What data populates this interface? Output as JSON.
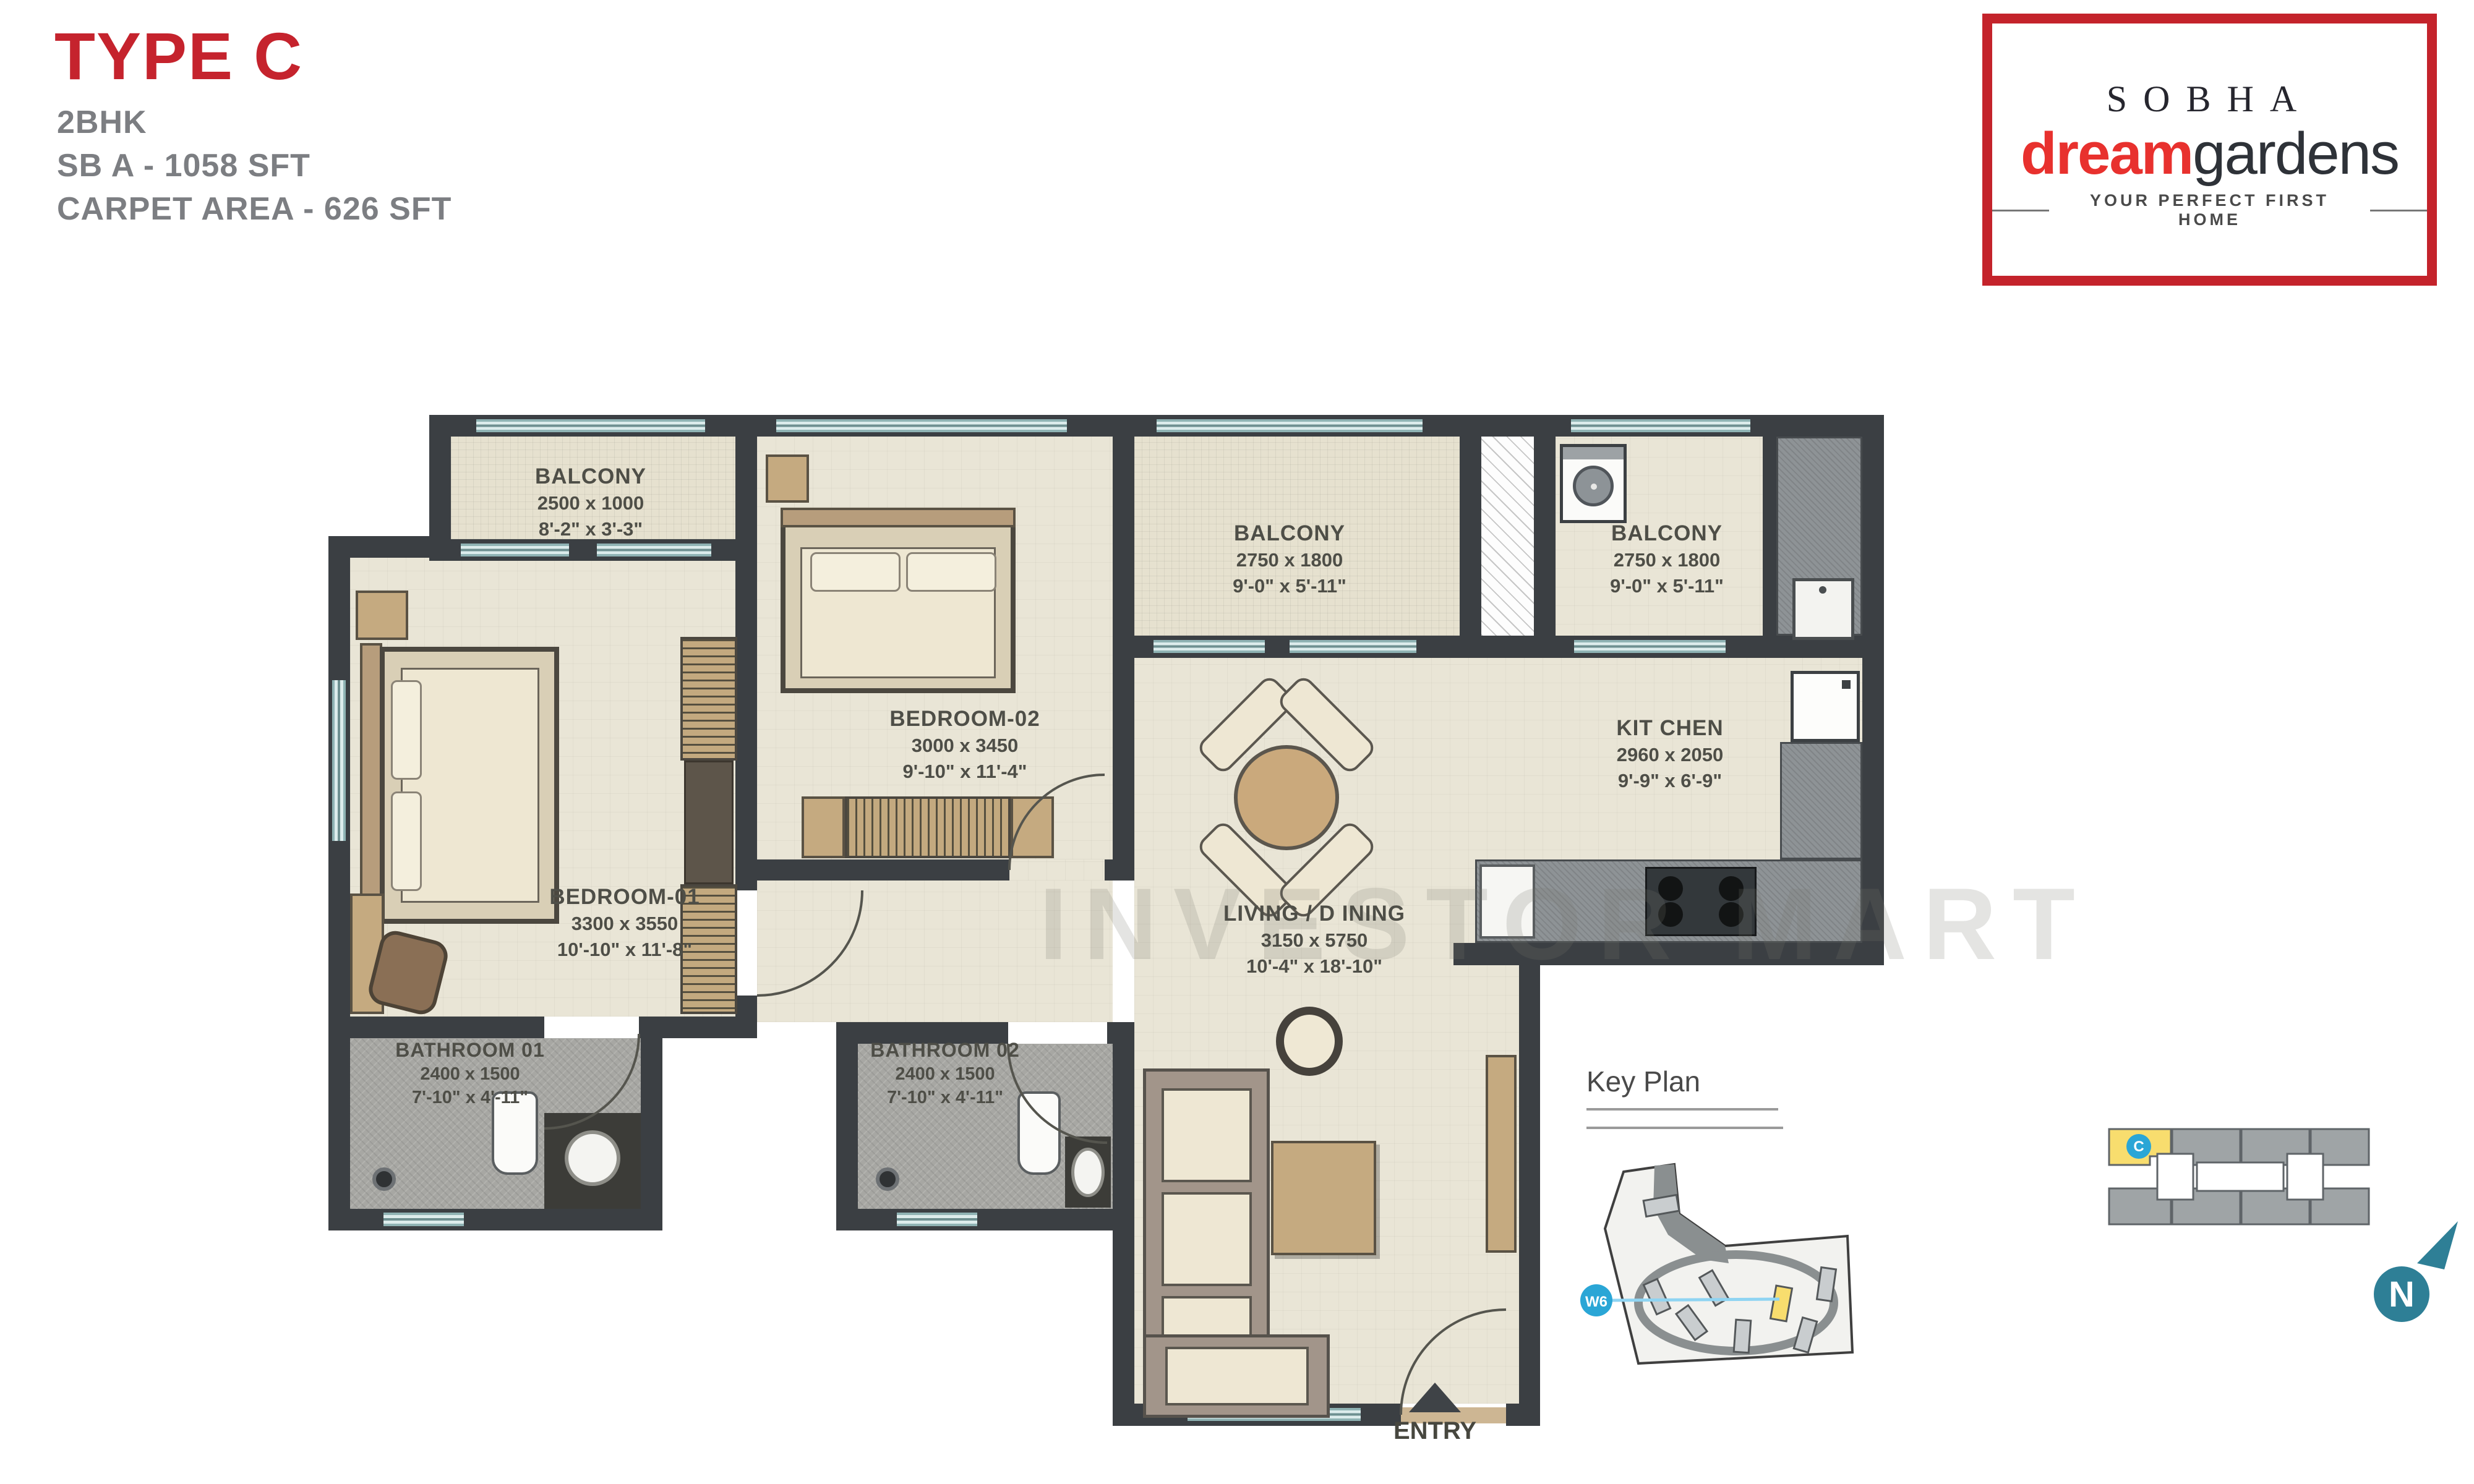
{
  "title_block": {
    "type": "TYPE C",
    "config": "2BHK",
    "sba": "SB A - 1058 SFT",
    "carpet": "CARPET  AREA - 626 SFT"
  },
  "logo": {
    "brand": "SOBHA",
    "brand_bold": "dream",
    "brand_light": "gardens",
    "tagline": "YOUR PERFECT FIRST HOME",
    "accent_color": "#c4232b"
  },
  "watermark": "INVESTOR MART",
  "rooms": {
    "balcony1": {
      "name": "BALCONY",
      "size_mm": "2500 x 1000",
      "size_ft": "8'-2\" x 3'-3\""
    },
    "bedroom2": {
      "name": "BEDROOM-02",
      "size_mm": "3000 x 3450",
      "size_ft": "9'-10\" x 11'-4\""
    },
    "balcony2": {
      "name": "BALCONY",
      "size_mm": "2750 x 1800",
      "size_ft": "9'-0\" x 5'-11\""
    },
    "balcony3": {
      "name": "BALCONY",
      "size_mm": "2750 x 1800",
      "size_ft": "9'-0\" x 5'-11\""
    },
    "kitchen": {
      "name": "KIT CHEN",
      "size_mm": "2960 x 2050",
      "size_ft": "9'-9\" x 6'-9\""
    },
    "bedroom1": {
      "name": "BEDROOM-01",
      "size_mm": "3300 x 3550",
      "size_ft": "10'-10\" x 11'-8\""
    },
    "living": {
      "name": "LIVING / D INING",
      "size_mm": "3150 x 5750",
      "size_ft": "10'-4\" x 18'-10\""
    },
    "bathroom1": {
      "name": "BATHROOM 01",
      "size_mm": "2400 x 1500",
      "size_ft": "7'-10\" x 4'-11\""
    },
    "bathroom2": {
      "name": "BATHROOM 02",
      "size_mm": "2400 x 1500",
      "size_ft": "7'-10\" x 4'-11\""
    }
  },
  "entry_label": "ENTRY",
  "key_plan": {
    "title": "Key Plan",
    "marker": "W6"
  },
  "floor_plate": {
    "unit_marker": "C"
  },
  "north_label": "N",
  "colors": {
    "wall": "#3b3f43",
    "floor": "#e9e5d6",
    "bath_floor": "#a7a7a3",
    "window": "#dcecec",
    "title_red": "#c5232d",
    "highlight_yellow": "#f8dd6e",
    "marker_blue": "#2aa6d6",
    "north_teal": "#2e7f96"
  }
}
